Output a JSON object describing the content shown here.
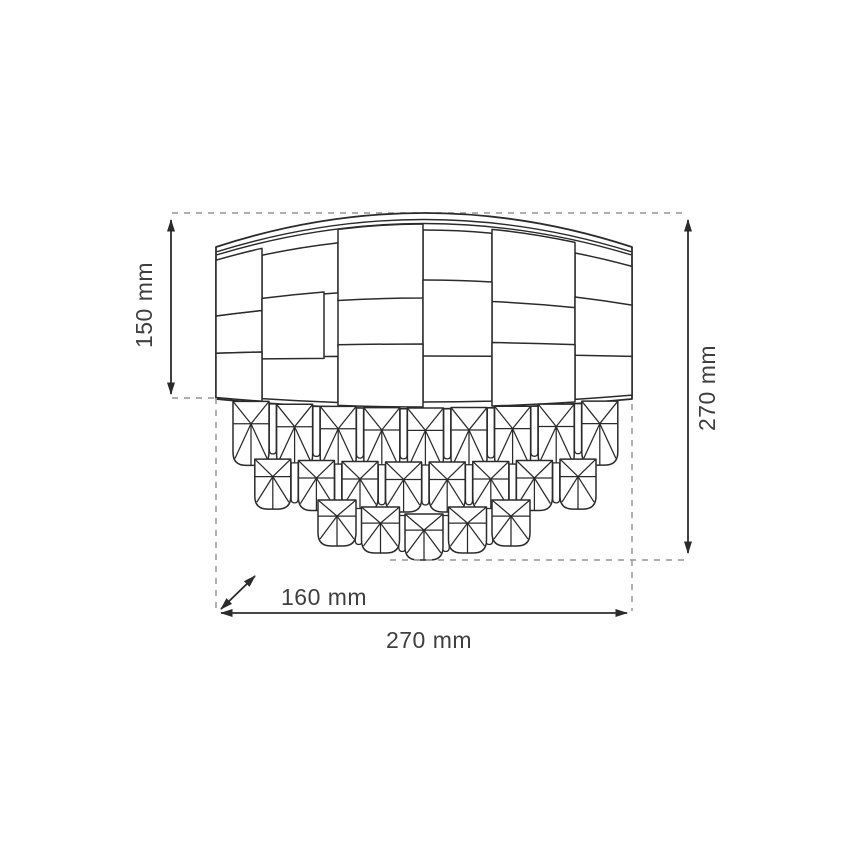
{
  "diagram": {
    "type": "dimension-drawing",
    "subject": "wall lamp with woven drum shade and hanging crystal drops",
    "dimensions": {
      "shade_height": {
        "label": "150 mm"
      },
      "total_height": {
        "label": "270 mm"
      },
      "depth": {
        "label": "160 mm"
      },
      "width": {
        "label": "270 mm"
      }
    },
    "figure": {
      "crystal_tiers": [
        9,
        8,
        5
      ]
    },
    "colors": {
      "line": "#2b2b2b",
      "dashed": "#a3a3a3",
      "text": "#3f3f3f",
      "background": "#ffffff"
    }
  }
}
